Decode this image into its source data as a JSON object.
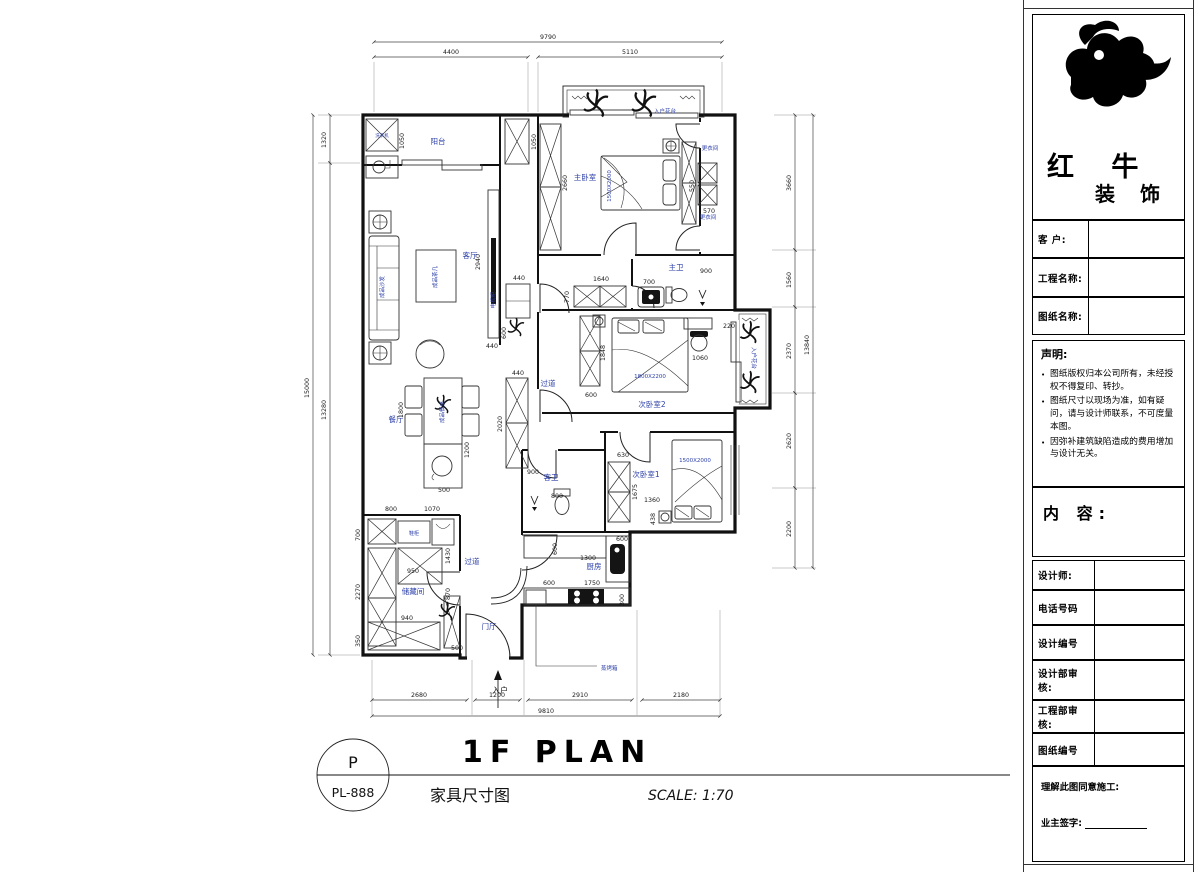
{
  "sheet": {
    "plan_title": "1F PLAN",
    "plan_subtitle": "家具尺寸图",
    "scale_label": "SCALE: 1:70",
    "badge_top": "P",
    "badge_code": "PL-888"
  },
  "plan": {
    "entrance_label": "入户",
    "room_labels": [
      {
        "text": "阳台",
        "x": 438,
        "y": 144
      },
      {
        "text": "客厅",
        "x": 470,
        "y": 258
      },
      {
        "text": "餐厅",
        "x": 396,
        "y": 422
      },
      {
        "text": "储藏间",
        "x": 413,
        "y": 594
      },
      {
        "text": "门厅",
        "x": 489,
        "y": 629
      },
      {
        "text": "过道",
        "x": 548,
        "y": 386
      },
      {
        "text": "过道",
        "x": 472,
        "y": 564
      },
      {
        "text": "厨房",
        "x": 594,
        "y": 569
      },
      {
        "text": "客卫",
        "x": 551,
        "y": 480
      },
      {
        "text": "主卫",
        "x": 676,
        "y": 270
      },
      {
        "text": "主卧室",
        "x": 585,
        "y": 180
      },
      {
        "text": "次卧室2",
        "x": 652,
        "y": 407
      },
      {
        "text": "次卧室1",
        "x": 646,
        "y": 477
      },
      {
        "text": "更衣间",
        "x": 710,
        "y": 150,
        "s": 5.5
      },
      {
        "text": "更衣间",
        "x": 708,
        "y": 219,
        "s": 5.5
      },
      {
        "text": "入户花台",
        "x": 665,
        "y": 113,
        "s": 5.5
      },
      {
        "text": "入户花台",
        "x": 752,
        "y": 358,
        "r": 90,
        "s": 5.5
      }
    ],
    "furniture_labels": [
      {
        "text": "成品沙发",
        "x": 384,
        "y": 287,
        "r": -90
      },
      {
        "text": "成品茶几",
        "x": 437,
        "y": 277,
        "r": -90
      },
      {
        "text": "电视柜",
        "x": 495,
        "y": 300,
        "r": -90
      },
      {
        "text": "成品餐桌",
        "x": 444,
        "y": 412,
        "r": -90
      },
      {
        "text": "洗衣机",
        "x": 382,
        "y": 137,
        "s": 4.5
      },
      {
        "text": "鞋柜",
        "x": 414,
        "y": 535,
        "s": 5
      },
      {
        "text": "1500X2000",
        "x": 611,
        "y": 186,
        "r": -90
      },
      {
        "text": "1800X2200",
        "x": 650,
        "y": 378
      },
      {
        "text": "1500X2000",
        "x": 695,
        "y": 462
      },
      {
        "text": "蒸烤箱",
        "x": 601,
        "y": 670,
        "anchor": "start"
      }
    ],
    "inner_dims": [
      {
        "text": "1050",
        "x": 404,
        "y": 141,
        "r": -90
      },
      {
        "text": "1050",
        "x": 536,
        "y": 142,
        "r": -90
      },
      {
        "text": "2940",
        "x": 480,
        "y": 262,
        "r": -90
      },
      {
        "text": "440",
        "x": 492,
        "y": 348
      },
      {
        "text": "600",
        "x": 506,
        "y": 333,
        "r": -90
      },
      {
        "text": "440",
        "x": 519,
        "y": 280
      },
      {
        "text": "440",
        "x": 518,
        "y": 375
      },
      {
        "text": "2020",
        "x": 502,
        "y": 424,
        "r": -90
      },
      {
        "text": "2660",
        "x": 567,
        "y": 183,
        "r": -90
      },
      {
        "text": "1640",
        "x": 601,
        "y": 281
      },
      {
        "text": "770",
        "x": 569,
        "y": 297,
        "r": -90
      },
      {
        "text": "700",
        "x": 649,
        "y": 284
      },
      {
        "text": "900",
        "x": 706,
        "y": 273
      },
      {
        "text": "550",
        "x": 694,
        "y": 186,
        "r": -90
      },
      {
        "text": "570",
        "x": 709,
        "y": 213
      },
      {
        "text": "220",
        "x": 729,
        "y": 328
      },
      {
        "text": "1848",
        "x": 605,
        "y": 353,
        "r": -90
      },
      {
        "text": "600",
        "x": 591,
        "y": 397
      },
      {
        "text": "1060",
        "x": 700,
        "y": 360
      },
      {
        "text": "630",
        "x": 623,
        "y": 457
      },
      {
        "text": "1675",
        "x": 637,
        "y": 492,
        "r": -90
      },
      {
        "text": "1360",
        "x": 652,
        "y": 502
      },
      {
        "text": "438",
        "x": 655,
        "y": 519,
        "r": -90
      },
      {
        "text": "900",
        "x": 533,
        "y": 474
      },
      {
        "text": "800",
        "x": 557,
        "y": 498
      },
      {
        "text": "600",
        "x": 622,
        "y": 541
      },
      {
        "text": "1300",
        "x": 588,
        "y": 560
      },
      {
        "text": "600",
        "x": 557,
        "y": 549,
        "r": -90
      },
      {
        "text": "600",
        "x": 549,
        "y": 585
      },
      {
        "text": "1750",
        "x": 592,
        "y": 585
      },
      {
        "text": "300",
        "x": 624,
        "y": 600,
        "r": -90
      },
      {
        "text": "1800",
        "x": 403,
        "y": 410,
        "r": -90
      },
      {
        "text": "1200",
        "x": 469,
        "y": 450,
        "r": -90
      },
      {
        "text": "500",
        "x": 444,
        "y": 492
      },
      {
        "text": "800",
        "x": 391,
        "y": 511
      },
      {
        "text": "1070",
        "x": 432,
        "y": 511
      },
      {
        "text": "700",
        "x": 360,
        "y": 535,
        "r": -90
      },
      {
        "text": "2270",
        "x": 360,
        "y": 592,
        "r": -90
      },
      {
        "text": "350",
        "x": 360,
        "y": 641,
        "r": -90
      },
      {
        "text": "1430",
        "x": 450,
        "y": 556,
        "r": -90
      },
      {
        "text": "950",
        "x": 413,
        "y": 573
      },
      {
        "text": "940",
        "x": 407,
        "y": 620
      },
      {
        "text": "870",
        "x": 450,
        "y": 594,
        "r": -90
      },
      {
        "text": "500",
        "x": 457,
        "y": 650
      }
    ]
  },
  "dims": {
    "top_overall": "9790",
    "top_segments": [
      "4400",
      "5110"
    ],
    "bottom_overall": "9810",
    "bottom_segments": [
      "2680",
      "1200",
      "2910",
      "2180"
    ],
    "left_overall": "15000",
    "left_segments": [
      "1320",
      "13280"
    ],
    "right_overall": "13840",
    "right_segments": [
      "3660",
      "1560",
      "2370",
      "2620",
      "2200"
    ]
  },
  "titleblock": {
    "brand_top": "红 牛",
    "brand_bottom": "装 饰",
    "fields_top": [
      "客  户:",
      "工程名称:",
      "图纸名称:"
    ],
    "statement_title": "声明:",
    "statements": [
      "图纸版权归本公司所有，未经授权不得复印、转抄。",
      "图纸尺寸以现场为准，如有疑问，请与设计师联系，不可度量本图。",
      "因弥补建筑缺陷造成的费用增加与设计无关。"
    ],
    "content_label": "内 容:",
    "fields_bottom": [
      "设计师:",
      "电话号码",
      "设计编号",
      "设计部审核:",
      "工程部审核:",
      "图纸编号"
    ],
    "agree_label": "理解此图同意施工:",
    "sign_label": "业主签字:"
  }
}
